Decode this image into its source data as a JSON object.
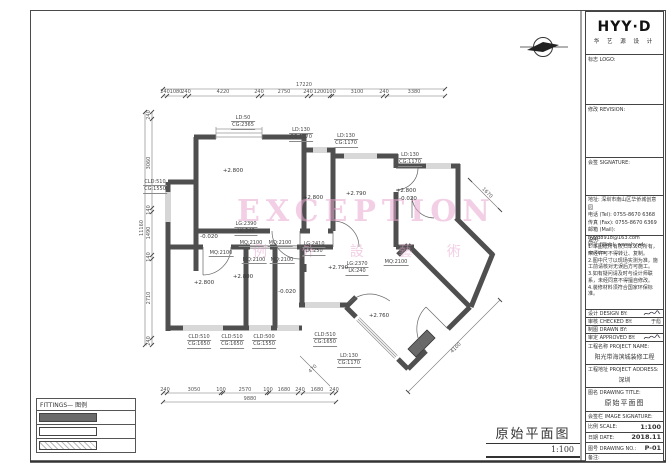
{
  "sheet": {
    "bg": "#ffffff",
    "line_color": "#4f4f4f",
    "wall_color": "#4f4f4f"
  },
  "logo": {
    "brand": "HYY·D",
    "sub": "华 艺 源 设 计"
  },
  "north_arrow": {
    "name": "north-arrow"
  },
  "watermark": {
    "line1": "EXCEPTION",
    "line2": "例 外 設 藝 術",
    "color": "#e7a8d0"
  },
  "plan_title": {
    "title": "原始平面图",
    "scale": "1:100"
  },
  "legend": {
    "header": "FITTINGS— 图例",
    "rows": [
      {
        "type": "wall-solid",
        "label": ""
      },
      {
        "type": "wall-outline",
        "label": ""
      },
      {
        "type": "wall-hatch",
        "label": ""
      }
    ]
  },
  "titleblock": {
    "sections": [
      {
        "label": "标志 LOGO:"
      },
      {
        "label": "修改 REVISION:"
      },
      {
        "label": "会签 SIGNATURE:"
      }
    ],
    "company_lines": [
      "地址: 深圳市南山区华侨城创意园",
      "电话 (Tel): 0755-8670 6368",
      "传真 (Fax): 0755-8670 6369",
      "邮箱 (Mail): hyyd8918@163.com",
      "网址 (Web): www.hyyd-sz.com"
    ],
    "notes_title": "说明:",
    "notes_lines": [
      "1.本图纸所有权归本公司所有，",
      "未经许可不得转让、复制。",
      "2.图中尺寸以现场实测为准，施",
      "工前请核对无误后方可施工。",
      "3.如有疑问请及时与设计师联",
      "系，未经同意不得擅自修改。",
      "4.装修材料须符合国家环保标准。"
    ],
    "sign_rows": [
      {
        "label": "设计 DESIGN BY:",
        "value": "",
        "has_scribble": true
      },
      {
        "label": "审核 CHECKED BY:",
        "value": "于彪",
        "has_scribble": false
      },
      {
        "label": "制图 DRAWN BY:",
        "value": "",
        "has_scribble": false
      },
      {
        "label": "审定 APPROVED BY:",
        "value": "",
        "has_scribble": true
      }
    ],
    "project_name_label": "工程名称 PROJECT NAME:",
    "project_name": "阳光带海滨城装修工程",
    "project_addr_label": "工程地址 PROJECT ADDRESS:",
    "project_addr": "深圳",
    "drawing_title_label": "图名 DRAWING TITLE:",
    "drawing_title": "原始平面图",
    "signature_label": "会签栏 IMAGE SIGNATURE:",
    "scale_label": "比例 SCALE:",
    "scale_value": "1:100",
    "date_label": "日期 DATE:",
    "date_value": "2018.11",
    "no_label": "图号 DRAWING NO.:",
    "no_value": "P-01",
    "remark_label": "备注:"
  },
  "plan": {
    "spec_labels": [
      {
        "x": 243,
        "y": 115,
        "lines": [
          "LD:50",
          "CG:2365"
        ]
      },
      {
        "x": 301,
        "y": 127,
        "lines": [
          "LD:130",
          "CG:1170"
        ]
      },
      {
        "x": 346,
        "y": 133,
        "lines": [
          "LD:130",
          "CG:1170"
        ]
      },
      {
        "x": 410,
        "y": 152,
        "lines": [
          "LD:130",
          "CG:1170"
        ]
      },
      {
        "x": 155,
        "y": 179,
        "lines": [
          "CLD:510",
          "CG:1550"
        ]
      },
      {
        "x": 246,
        "y": 221,
        "lines": [
          "LG:2390",
          "LK:240"
        ]
      },
      {
        "x": 314,
        "y": 241,
        "lines": [
          "LG:2410",
          "LK:250"
        ]
      },
      {
        "x": 357,
        "y": 261,
        "lines": [
          "LG:2370",
          "LK:240"
        ]
      },
      {
        "x": 221,
        "y": 250,
        "lines": [
          "MQ:2100"
        ]
      },
      {
        "x": 251,
        "y": 240,
        "lines": [
          "MQ:2100"
        ]
      },
      {
        "x": 280,
        "y": 240,
        "lines": [
          "MQ:2100"
        ]
      },
      {
        "x": 254,
        "y": 257,
        "lines": [
          "MQ:2100"
        ]
      },
      {
        "x": 282,
        "y": 257,
        "lines": [
          "MQ:2100"
        ]
      },
      {
        "x": 396,
        "y": 259,
        "lines": [
          "MQ:2100"
        ]
      },
      {
        "x": 199,
        "y": 334,
        "lines": [
          "CLD:510",
          "CG:1650"
        ]
      },
      {
        "x": 232,
        "y": 334,
        "lines": [
          "CLD:510",
          "CG:1650"
        ]
      },
      {
        "x": 264,
        "y": 334,
        "lines": [
          "CLD:500",
          "CG:1550"
        ]
      },
      {
        "x": 325,
        "y": 332,
        "lines": [
          "CLD:510",
          "CG:1650"
        ]
      },
      {
        "x": 349,
        "y": 353,
        "lines": [
          "LD:130",
          "CG:1170"
        ]
      }
    ],
    "level_labels": [
      {
        "x": 233,
        "y": 168,
        "text": "+2.800"
      },
      {
        "x": 313,
        "y": 195,
        "text": "+2.800"
      },
      {
        "x": 356,
        "y": 191,
        "text": "+2.790"
      },
      {
        "x": 406,
        "y": 188,
        "text": "+2.800"
      },
      {
        "x": 408,
        "y": 196,
        "text": "-0.020"
      },
      {
        "x": 209,
        "y": 234,
        "text": "-0.020"
      },
      {
        "x": 204,
        "y": 280,
        "text": "+2.800"
      },
      {
        "x": 243,
        "y": 274,
        "text": "+2.800"
      },
      {
        "x": 287,
        "y": 289,
        "text": "-0.020"
      },
      {
        "x": 338,
        "y": 265,
        "text": "+2.790"
      },
      {
        "x": 379,
        "y": 313,
        "text": "+2.760"
      }
    ],
    "dim_labels": [
      {
        "text": "240",
        "x": 165,
        "y": 92,
        "rot": 0
      },
      {
        "text": "1080",
        "x": 176,
        "y": 92,
        "rot": 0
      },
      {
        "text": "240",
        "x": 186,
        "y": 92,
        "rot": 0
      },
      {
        "text": "4220",
        "x": 223,
        "y": 92,
        "rot": 0
      },
      {
        "text": "240",
        "x": 259,
        "y": 92,
        "rot": 0
      },
      {
        "text": "2750",
        "x": 284,
        "y": 92,
        "rot": 0
      },
      {
        "text": "240",
        "x": 308,
        "y": 92,
        "rot": 0
      },
      {
        "text": "1200",
        "x": 320,
        "y": 92,
        "rot": 0
      },
      {
        "text": "100",
        "x": 331,
        "y": 92,
        "rot": 0
      },
      {
        "text": "3100",
        "x": 357,
        "y": 92,
        "rot": 0
      },
      {
        "text": "240",
        "x": 384,
        "y": 92,
        "rot": 0
      },
      {
        "text": "3380",
        "x": 414,
        "y": 92,
        "rot": 0
      },
      {
        "text": "17220",
        "x": 304,
        "y": 85,
        "rot": 0
      },
      {
        "text": "240",
        "x": 165,
        "y": 390,
        "rot": 0
      },
      {
        "text": "3050",
        "x": 194,
        "y": 390,
        "rot": 0
      },
      {
        "text": "100",
        "x": 221,
        "y": 390,
        "rot": 0
      },
      {
        "text": "2570",
        "x": 245,
        "y": 390,
        "rot": 0
      },
      {
        "text": "100",
        "x": 268,
        "y": 390,
        "rot": 0
      },
      {
        "text": "1680",
        "x": 284,
        "y": 390,
        "rot": 0
      },
      {
        "text": "240",
        "x": 300,
        "y": 390,
        "rot": 0
      },
      {
        "text": "1680",
        "x": 317,
        "y": 390,
        "rot": 0
      },
      {
        "text": "240",
        "x": 334,
        "y": 390,
        "rot": 0
      },
      {
        "text": "9880",
        "x": 250,
        "y": 399,
        "rot": 0
      },
      {
        "text": "240",
        "x": 149,
        "y": 115,
        "rot": -90
      },
      {
        "text": "3060",
        "x": 149,
        "y": 163,
        "rot": -90
      },
      {
        "text": "140",
        "x": 149,
        "y": 210,
        "rot": -90
      },
      {
        "text": "1490",
        "x": 149,
        "y": 233,
        "rot": -90
      },
      {
        "text": "140",
        "x": 149,
        "y": 257,
        "rot": -90
      },
      {
        "text": "2710",
        "x": 149,
        "y": 298,
        "rot": -90
      },
      {
        "text": "240",
        "x": 149,
        "y": 341,
        "rot": -90
      },
      {
        "text": "11160",
        "x": 142,
        "y": 228,
        "rot": -90
      },
      {
        "text": "4100",
        "x": 456,
        "y": 348,
        "rot": -45
      },
      {
        "text": "1670",
        "x": 487,
        "y": 193,
        "rot": 45
      },
      {
        "text": "470",
        "x": 313,
        "y": 369,
        "rot": -45
      }
    ]
  }
}
